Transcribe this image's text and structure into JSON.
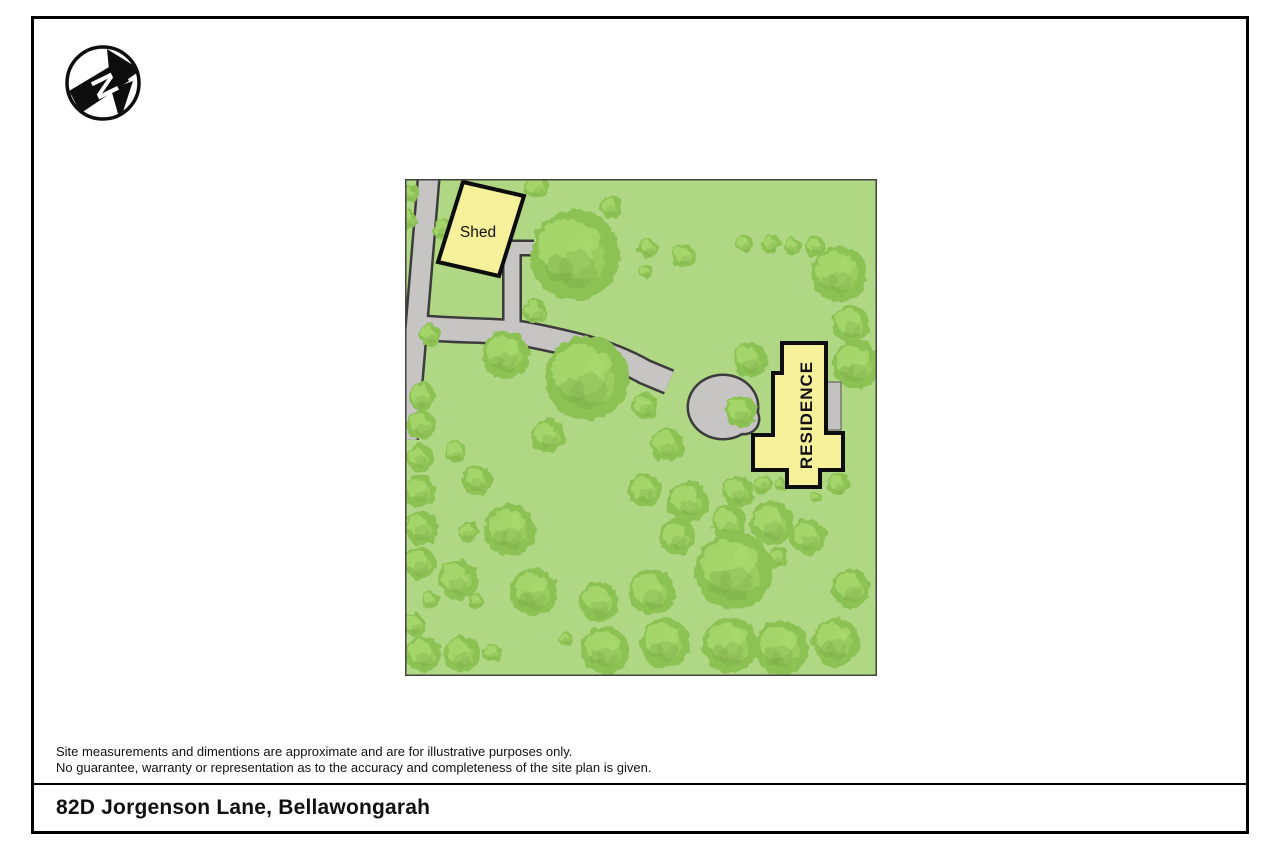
{
  "page": {
    "compass": {
      "letter": "N"
    },
    "disclaimer": {
      "line1": "Site measurements and dimentions are approximate and are for illustrative purposes only.",
      "line2": "No guarantee, warranty or representation as to the accuracy and completeness of the site plan is given."
    },
    "address": "82D Jorgenson Lane, Bellawongarah"
  },
  "site_plan": {
    "labels": {
      "shed": "Shed",
      "residence": "RESIDENCE"
    },
    "colors": {
      "ground": "#b0d884",
      "tree": "#8cc153",
      "tree_light": "#a8d86e",
      "tree_dark": "#78a846",
      "road": "#c6c5c3",
      "road_edge": "#3c3c3c",
      "building_fill": "#f8f19c",
      "building_border": "#0d0d0d",
      "deck": "#c2c1bf",
      "border": "#444444"
    },
    "roads": {
      "lane": {
        "path": "M24,-5 L2,260",
        "w": 19
      },
      "drive": {
        "path": "M8,148 C60,153 95,150 125,156 C170,165 205,173 240,193 L264,203",
        "w": 22
      },
      "spur": {
        "path": "M107,148 L107,70",
        "w": 15
      },
      "arm": {
        "path": "M106,69 L129,69",
        "w": 12
      },
      "bulb": {
        "cx": 318,
        "cy": 228,
        "rx": 34,
        "ry": 31
      },
      "bulb2": {
        "cx": 339,
        "cy": 240,
        "rx": 14,
        "ry": 14
      }
    },
    "buildings": {
      "shed": {
        "points": "58,3 119,17 94,97 33,83"
      },
      "residence": {
        "points": "377,164 421,164 421,254 438,254 438,291 415,291 415,308 382,308 382,291 348,291 348,256 368,256 368,194 377,194"
      },
      "deck": {
        "x": 421,
        "y": 203,
        "w": 15,
        "h": 48
      }
    },
    "trees": [
      [
        5,
        15,
        9
      ],
      [
        3,
        41,
        9
      ],
      [
        38,
        50,
        11
      ],
      [
        50,
        71,
        13
      ],
      [
        132,
        8,
        12
      ],
      [
        206,
        28,
        11
      ],
      [
        170,
        76,
        45
      ],
      [
        130,
        133,
        12
      ],
      [
        25,
        156,
        11
      ],
      [
        243,
        69,
        10
      ],
      [
        279,
        77,
        12
      ],
      [
        240,
        93,
        7
      ],
      [
        339,
        65,
        9
      ],
      [
        366,
        65,
        9
      ],
      [
        387,
        67,
        9
      ],
      [
        410,
        67,
        10
      ],
      [
        434,
        95,
        28
      ],
      [
        446,
        145,
        19
      ],
      [
        451,
        186,
        24
      ],
      [
        101,
        176,
        24
      ],
      [
        182,
        199,
        42
      ],
      [
        240,
        227,
        13
      ],
      [
        262,
        266,
        17
      ],
      [
        345,
        181,
        17
      ],
      [
        336,
        233,
        16
      ],
      [
        143,
        257,
        17
      ],
      [
        17,
        218,
        14
      ],
      [
        16,
        246,
        15
      ],
      [
        15,
        279,
        14
      ],
      [
        15,
        312,
        16
      ],
      [
        16,
        349,
        17
      ],
      [
        15,
        384,
        16
      ],
      [
        51,
        273,
        11
      ],
      [
        72,
        301,
        15
      ],
      [
        63,
        353,
        10
      ],
      [
        105,
        351,
        26
      ],
      [
        26,
        421,
        8
      ],
      [
        10,
        446,
        12
      ],
      [
        18,
        475,
        18
      ],
      [
        57,
        475,
        18
      ],
      [
        71,
        422,
        8
      ],
      [
        87,
        474,
        9
      ],
      [
        53,
        401,
        20
      ],
      [
        129,
        413,
        24
      ],
      [
        161,
        460,
        7
      ],
      [
        194,
        423,
        20
      ],
      [
        200,
        471,
        24
      ],
      [
        240,
        311,
        17
      ],
      [
        283,
        323,
        21
      ],
      [
        333,
        313,
        16
      ],
      [
        358,
        306,
        9
      ],
      [
        375,
        305,
        6
      ],
      [
        433,
        305,
        11
      ],
      [
        411,
        319,
        6
      ],
      [
        272,
        358,
        18
      ],
      [
        324,
        344,
        17
      ],
      [
        367,
        344,
        22
      ],
      [
        403,
        358,
        18
      ],
      [
        373,
        379,
        10
      ],
      [
        329,
        392,
        39
      ],
      [
        247,
        413,
        23
      ],
      [
        446,
        409,
        19
      ],
      [
        260,
        464,
        25
      ],
      [
        325,
        466,
        28
      ],
      [
        377,
        469,
        27
      ],
      [
        431,
        463,
        24
      ]
    ]
  }
}
